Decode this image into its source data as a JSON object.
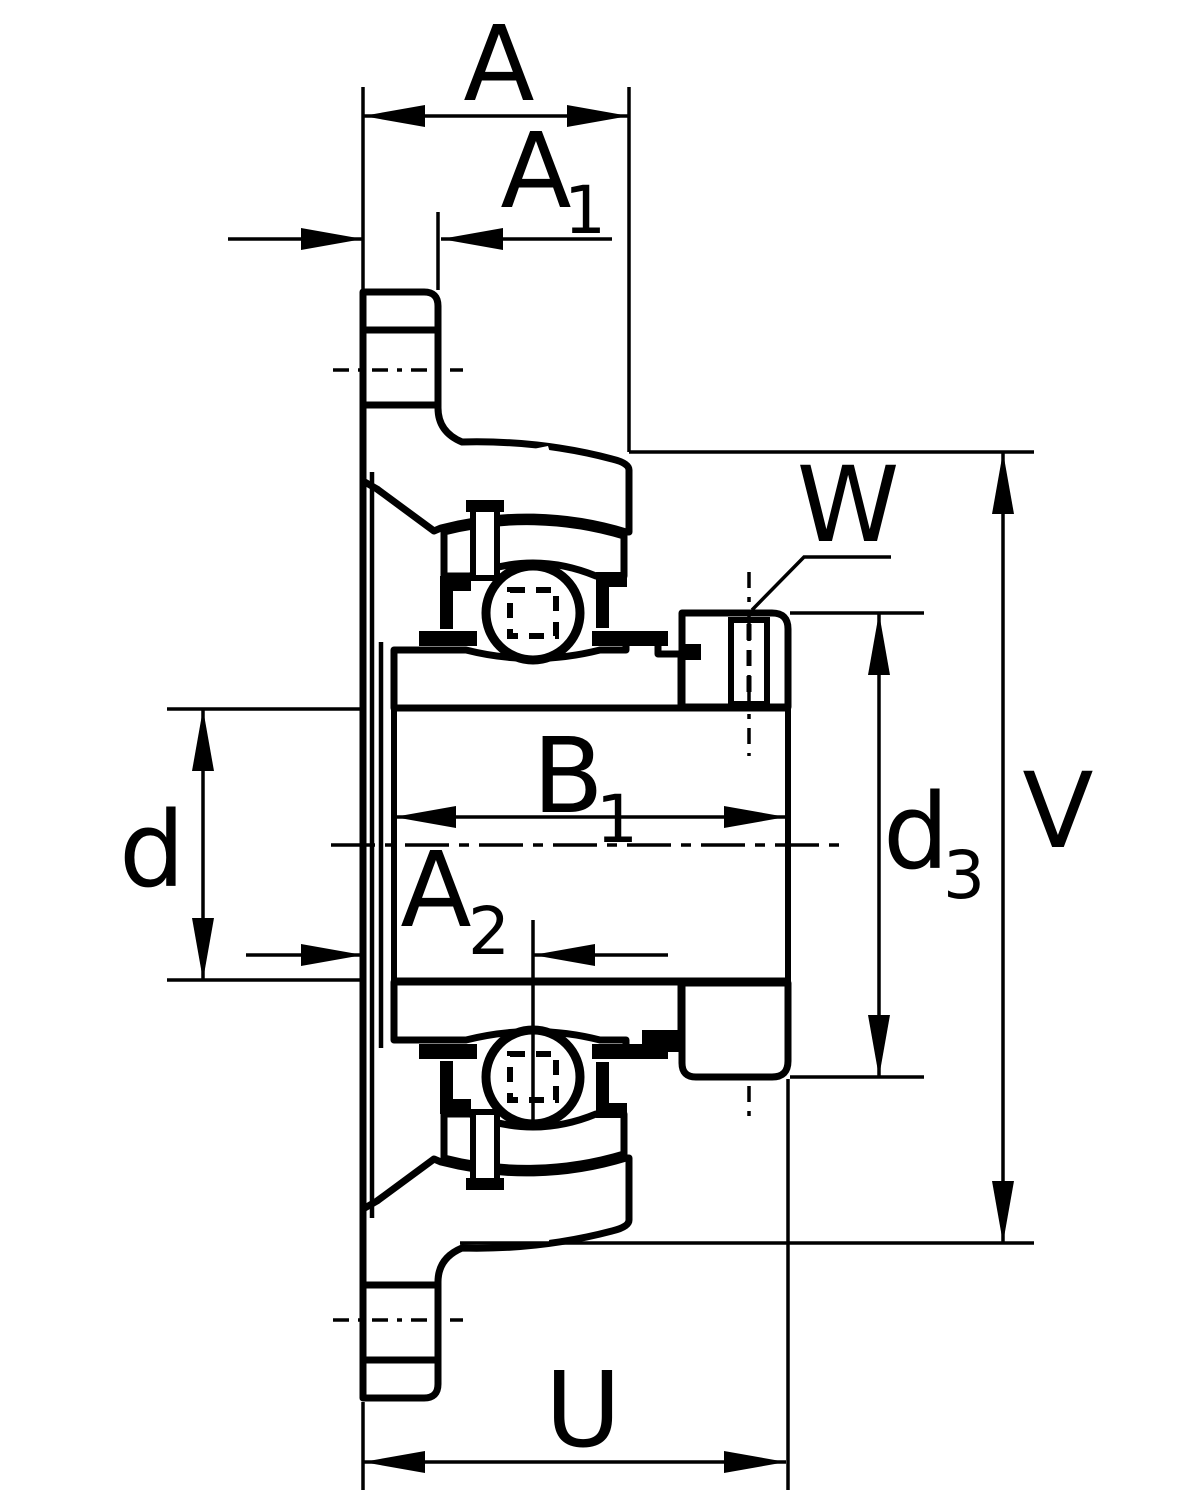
{
  "page": {
    "background": "#ffffff",
    "line_color": "#000000"
  },
  "drawing": {
    "kind": "technical-cross-section",
    "subject": "Two-bolt oval flanged bearing housing unit with insert ball bearing and eccentric locking collar with set screw",
    "view": "side section view with dimension lines"
  },
  "labels": {
    "A": {
      "base": "A",
      "sub": ""
    },
    "A1": {
      "base": "A",
      "sub": "1"
    },
    "A2": {
      "base": "A",
      "sub": "2"
    },
    "B1": {
      "base": "B",
      "sub": "1"
    },
    "d": {
      "base": "d",
      "sub": ""
    },
    "d3": {
      "base": "d",
      "sub": "3"
    },
    "V": {
      "base": "V",
      "sub": ""
    },
    "W": {
      "base": "W",
      "sub": ""
    },
    "U": {
      "base": "U",
      "sub": ""
    }
  }
}
